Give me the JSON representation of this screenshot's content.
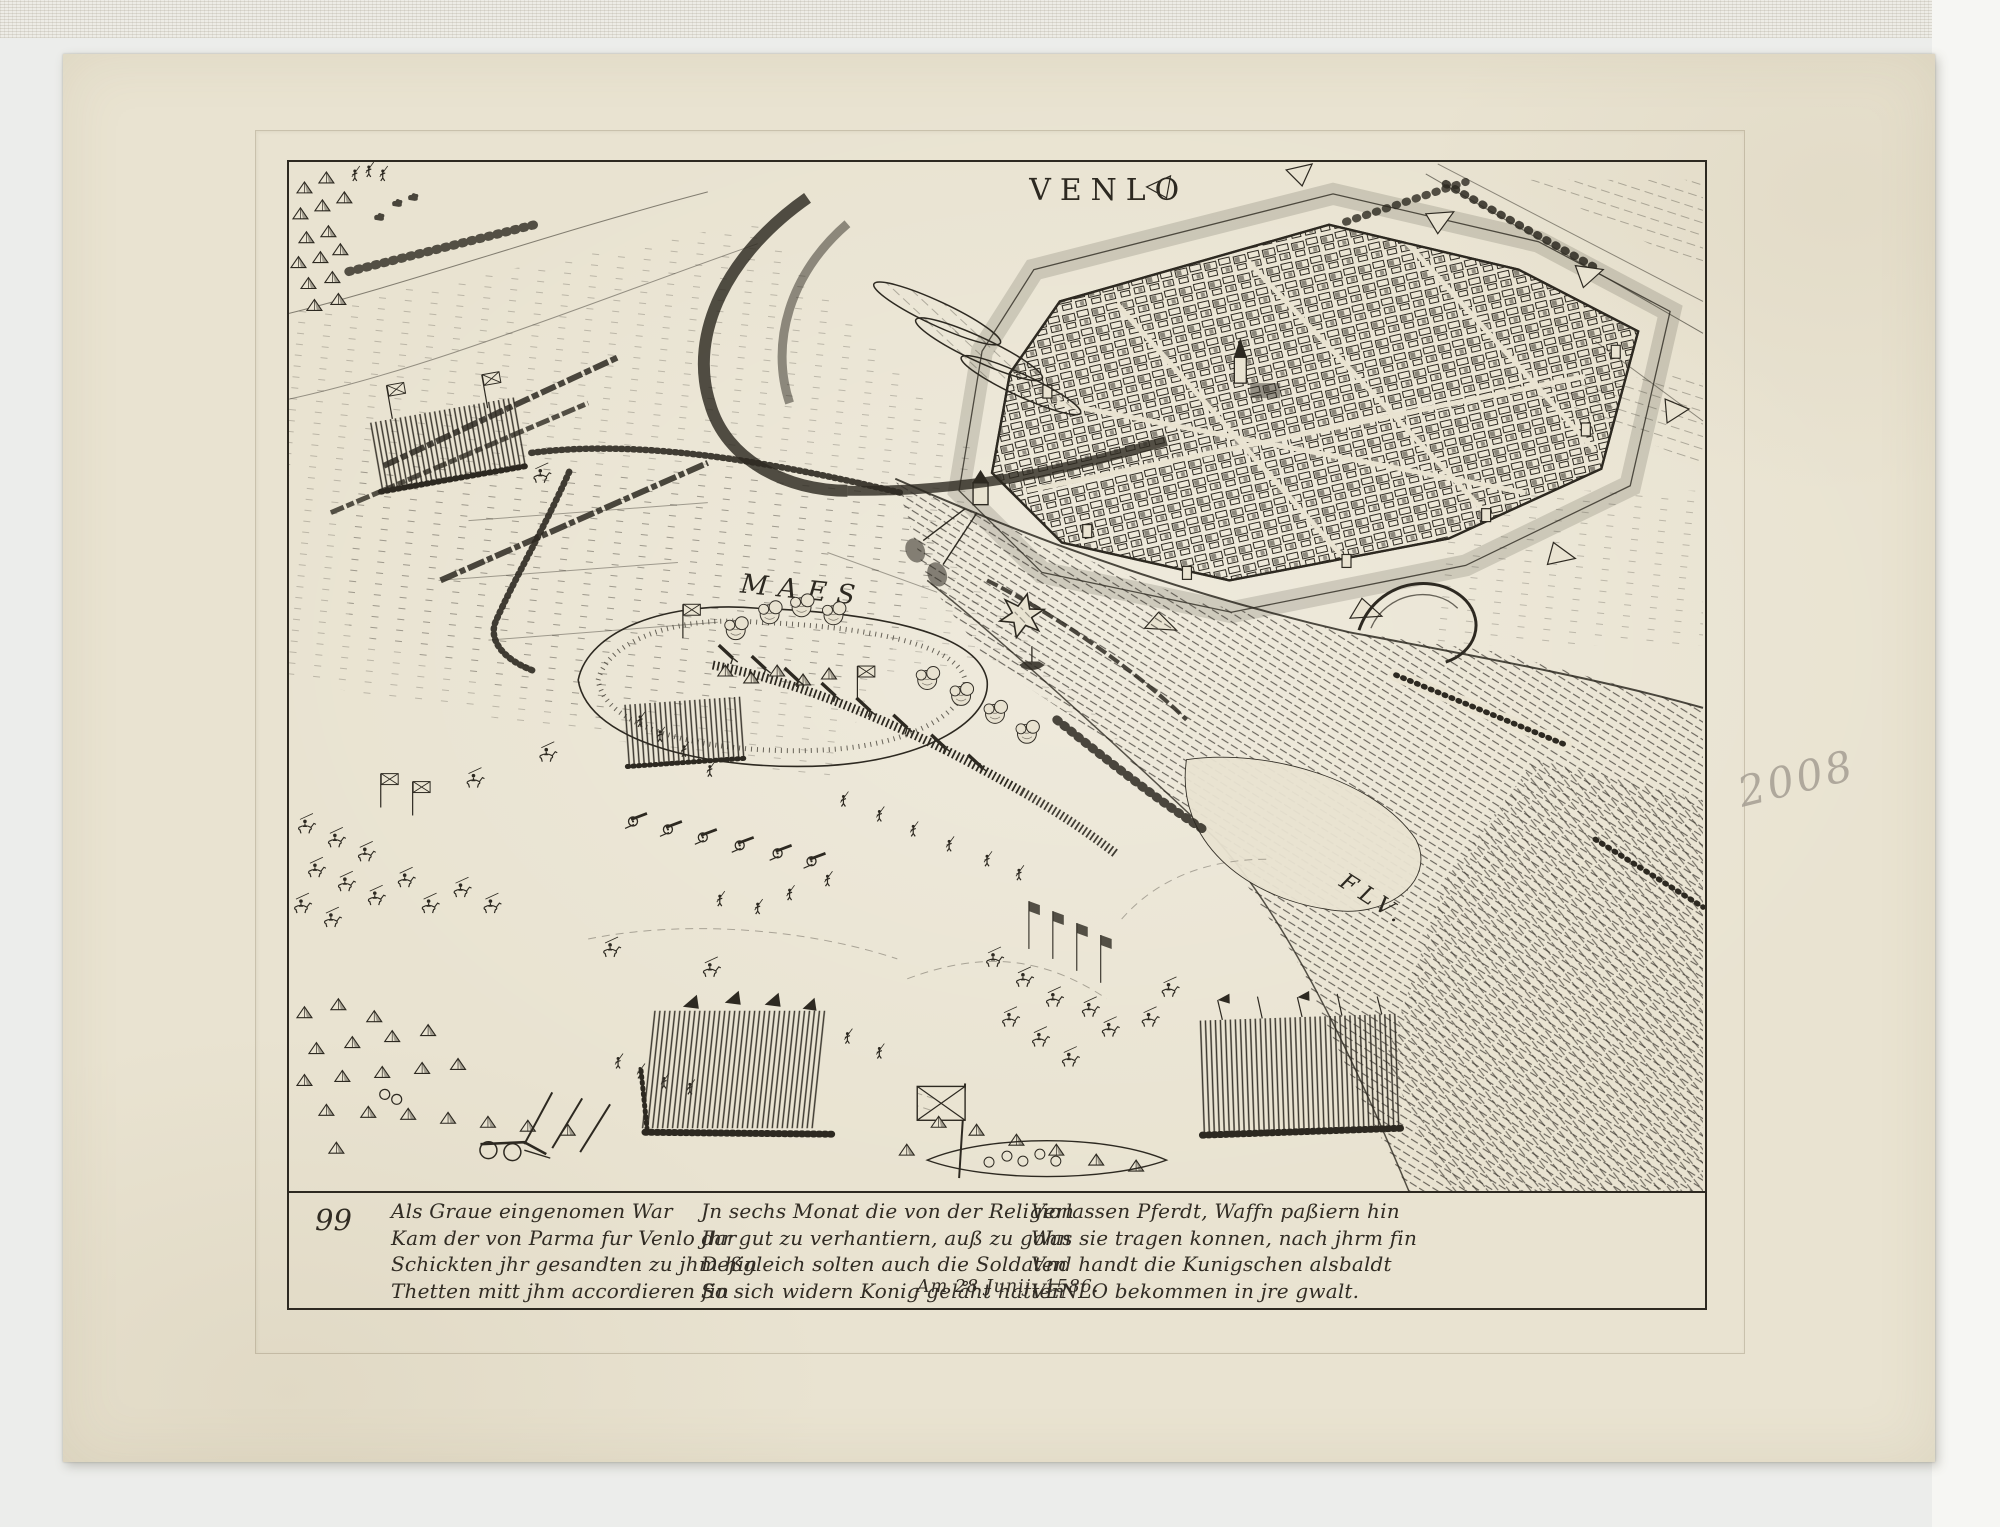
{
  "print": {
    "title": "VENLO",
    "labels": {
      "river": "MAES",
      "river2": "FLV."
    },
    "caption": {
      "plate_number": "99",
      "columns": [
        {
          "lines": [
            "Als Graue eingenomen War",
            "Kam der von Parma fur Venlo dar",
            "Schickten jhr gesandten zu jhm hin",
            "Thetten mitt jhm accordieren fin"
          ]
        },
        {
          "lines": [
            "Jn sechs Monat die von der Religion",
            "Jhr gut zu verhantiern, auß zu gohn",
            "Deßgleich solten auch die Soldaten",
            "So sich widern Konig gelåht hatten"
          ]
        },
        {
          "lines": [
            "Verlassen Pferdt, Waffn paßiern hin",
            "Was sie tragen konnen, nach jhrm fin",
            "Vnd handt die Kunigschen alsbaldt",
            "VENLO bekommen in jre gwalt."
          ]
        }
      ],
      "date_line": "Am 28 Junij. 1586."
    },
    "colors": {
      "paper": "#e9e3d1",
      "ink": "#2d2921",
      "pencil": "#a59e93",
      "scan_bg": "#ecedeb"
    }
  },
  "scan": {
    "pencil_inscription": "2008"
  }
}
